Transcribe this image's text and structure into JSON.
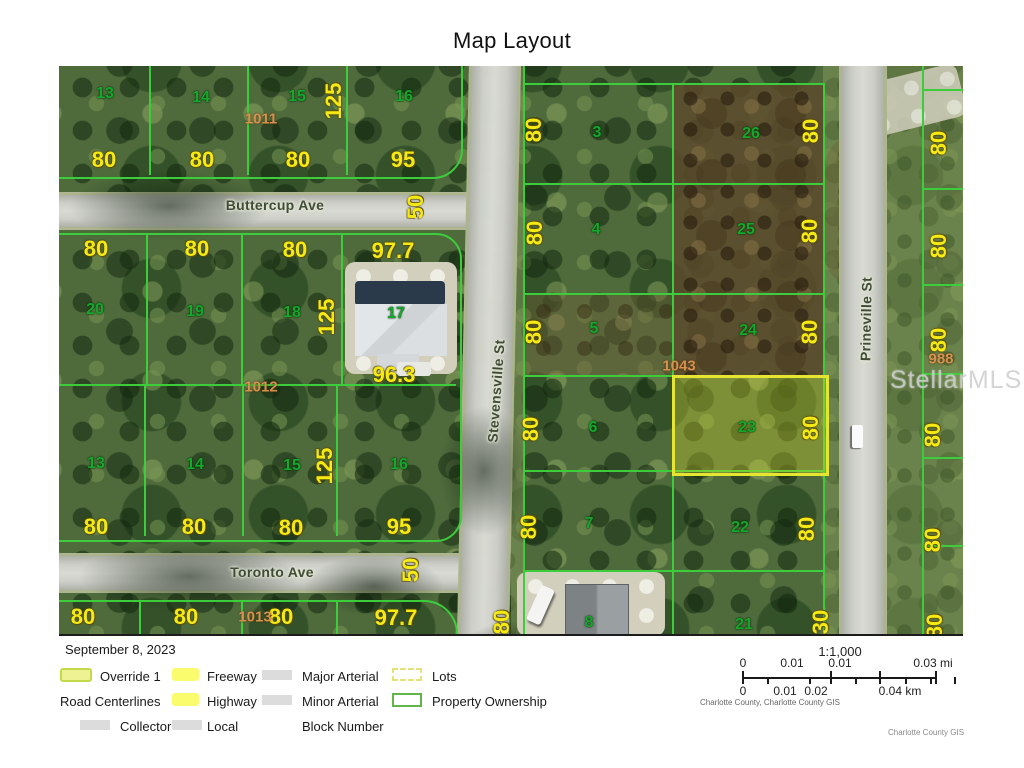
{
  "title": "Map Layout",
  "date": "September 8, 2023",
  "colors": {
    "parcel_line": "#3ccc3c",
    "highlight_parcel": "#e6e632",
    "lot_number_text": "#16a72e",
    "dimension_text": "#f6ea14",
    "block_number_text": "#d5924e",
    "legend_yellow": "#fbfb6e",
    "legend_gray": "#dcdcdc",
    "ownership_green": "#62b649"
  },
  "map": {
    "watermark": "StellarMLS",
    "street_names": [
      "Buttercup Ave",
      "Toronto Ave",
      "Stevensville St",
      "Prineville St"
    ],
    "label_groups": [
      {
        "cls": "street-label",
        "name": "street-label",
        "items": [
          [
            "Buttercup Ave",
            216,
            139,
            0
          ],
          [
            "Toronto Ave",
            213,
            506,
            0
          ],
          [
            "Stevensville St",
            437,
            325,
            -86
          ],
          [
            "Prineville St",
            807,
            253,
            -89
          ]
        ]
      },
      {
        "cls": "lot-label",
        "name": "lot-number-label",
        "items": [
          [
            "13",
            46,
            28,
            0
          ],
          [
            "14",
            142,
            32,
            0
          ],
          [
            "15",
            238,
            31,
            0
          ],
          [
            "16",
            345,
            31,
            0
          ],
          [
            "20",
            36,
            244,
            0
          ],
          [
            "19",
            136,
            246,
            0
          ],
          [
            "18",
            233,
            247,
            0
          ],
          [
            "17",
            337,
            248,
            0
          ],
          [
            "13",
            37,
            398,
            0
          ],
          [
            "14",
            136,
            399,
            0
          ],
          [
            "15",
            233,
            400,
            0
          ],
          [
            "16",
            340,
            399,
            0
          ],
          [
            "3",
            538,
            67,
            0
          ],
          [
            "26",
            692,
            68,
            0
          ],
          [
            "4",
            537,
            164,
            0
          ],
          [
            "25",
            687,
            164,
            0
          ],
          [
            "5",
            535,
            263,
            0
          ],
          [
            "24",
            689,
            265,
            0
          ],
          [
            "6",
            534,
            362,
            0
          ],
          [
            "23",
            688,
            362,
            0
          ],
          [
            "7",
            530,
            458,
            0
          ],
          [
            "22",
            681,
            462,
            0
          ],
          [
            "8",
            530,
            557,
            0
          ],
          [
            "21",
            685,
            559,
            0
          ]
        ]
      },
      {
        "cls": "dim-label",
        "name": "dimension-label",
        "items": [
          [
            "80",
            45,
            94,
            0
          ],
          [
            "80",
            143,
            94,
            0
          ],
          [
            "80",
            239,
            94,
            0
          ],
          [
            "95",
            344,
            94,
            0
          ],
          [
            "125",
            275,
            35,
            -90
          ],
          [
            "50",
            357,
            141,
            -90
          ],
          [
            "80",
            37,
            183,
            0
          ],
          [
            "80",
            138,
            183,
            0
          ],
          [
            "80",
            236,
            184,
            0
          ],
          [
            "97.7",
            334,
            185,
            0
          ],
          [
            "125",
            268,
            251,
            -90
          ],
          [
            "96.3",
            335,
            309,
            0
          ],
          [
            "125",
            266,
            400,
            -90
          ],
          [
            "80",
            37,
            461,
            0
          ],
          [
            "80",
            135,
            461,
            0
          ],
          [
            "80",
            232,
            462,
            0
          ],
          [
            "95",
            340,
            461,
            0
          ],
          [
            "50",
            352,
            504,
            -90
          ],
          [
            "80",
            24,
            551,
            0
          ],
          [
            "80",
            127,
            551,
            0
          ],
          [
            "80",
            222,
            551,
            0
          ],
          [
            "97.7",
            337,
            552,
            0
          ],
          [
            "80",
            475,
            64,
            -90
          ],
          [
            "80",
            476,
            167,
            -90
          ],
          [
            "80",
            475,
            266,
            -90
          ],
          [
            "80",
            472,
            363,
            -90
          ],
          [
            "80",
            470,
            461,
            -90
          ],
          [
            "80",
            443,
            556,
            -90
          ],
          [
            "80",
            752,
            65,
            -90
          ],
          [
            "80",
            751,
            165,
            -90
          ],
          [
            "80",
            751,
            266,
            -90
          ],
          [
            "80",
            752,
            362,
            -90
          ],
          [
            "80",
            748,
            463,
            -90
          ],
          [
            "30",
            762,
            556,
            -90
          ],
          [
            "80",
            880,
            77,
            -90
          ],
          [
            "80",
            880,
            180,
            -90
          ],
          [
            "80",
            880,
            274,
            -90
          ],
          [
            "80",
            874,
            369,
            -90
          ],
          [
            "80",
            874,
            474,
            -90
          ],
          [
            "80",
            876,
            560,
            -90
          ]
        ]
      },
      {
        "cls": "block-label",
        "name": "block-number-label",
        "items": [
          [
            "1011",
            202,
            53,
            0
          ],
          [
            "1012",
            202,
            321,
            0
          ],
          [
            "1013",
            196,
            551,
            0
          ],
          [
            "1043",
            620,
            300,
            0
          ],
          [
            "988",
            882,
            293,
            0
          ]
        ]
      }
    ]
  },
  "legend": {
    "rows": [
      {
        "top": 27,
        "cells": [
          {
            "swatch": "override",
            "sx": 1,
            "label": "Override 1",
            "lx": 41
          },
          {
            "swatch": "freeway",
            "sx": 113,
            "label": "Freeway",
            "lx": 148
          },
          {
            "swatch": "arterial",
            "sx": 203,
            "label": "Major Arterial",
            "lx": 243
          },
          {
            "swatch": "lots",
            "sx": 333,
            "label": "Lots",
            "lx": 373
          }
        ]
      },
      {
        "top": 52,
        "cells": [
          {
            "swatch": "none",
            "sx": 0,
            "label": "Road Centerlines",
            "lx": 1
          },
          {
            "swatch": "highway",
            "sx": 113,
            "label": "Highway",
            "lx": 148
          },
          {
            "swatch": "arterial",
            "sx": 203,
            "label": "Minor Arterial",
            "lx": 243
          },
          {
            "swatch": "ownership",
            "sx": 333,
            "label": "Property Ownership",
            "lx": 373
          }
        ]
      },
      {
        "top": 77,
        "cells": [
          {
            "swatch": "collector",
            "sx": 21,
            "label": "Collector",
            "lx": 61
          },
          {
            "swatch": "local",
            "sx": 113,
            "label": "Local",
            "lx": 148
          },
          {
            "swatch": "none",
            "sx": 0,
            "label": "Block Number",
            "lx": 243
          }
        ]
      }
    ]
  },
  "scalebar": {
    "ratio": "1:1,000",
    "mi_labels": [
      [
        "0",
        43
      ],
      [
        "0.01",
        92
      ],
      [
        "0.01",
        140
      ],
      [
        "0.03 mi",
        233
      ]
    ],
    "km_labels": [
      [
        "0",
        43
      ],
      [
        "0.01",
        85
      ],
      [
        "0.02",
        116
      ],
      [
        "0.04 km",
        200
      ]
    ],
    "attribution": "Charlotte County, Charlotte County GIS",
    "credit": "Charlotte County GIS"
  }
}
